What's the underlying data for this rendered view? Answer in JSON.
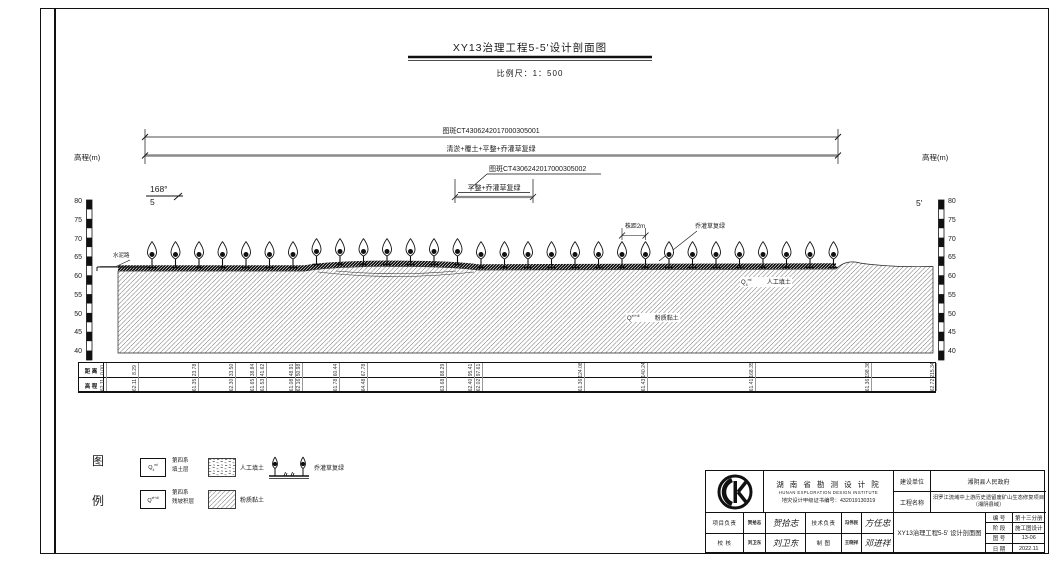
{
  "sheet": {
    "title": "XY13治理工程5-5'设计剖面图",
    "scale_label": "比例尺：1：500"
  },
  "annotations": {
    "patch1_label": "图斑CT4306242017000305001",
    "patch1_treatment": "清淤+覆土+平整+乔灌草复绿",
    "patch2_label": "图斑CT4306242017000305002",
    "patch2_treatment": "平整+乔灌草复绿",
    "section_start_angle": "168°",
    "section_start_id": "5",
    "section_end_id": "5'",
    "elevation_axis_label": "高程(m)",
    "cement_road_label": "水泥路",
    "plant_spacing_label": "株距2m",
    "regreen_label": "乔灌草复绿",
    "fill_soil_symbol": {
      "base": "Q",
      "sub": "4",
      "sup": "ml"
    },
    "fill_soil_label": "人工填土",
    "clay_symbol": {
      "base": "Q",
      "sub": "",
      "sup": "el+dl"
    },
    "clay_label": "粉质黏土"
  },
  "elevation_axis": {
    "ticks": [
      "80",
      "75",
      "70",
      "65",
      "60",
      "55",
      "50",
      "45",
      "40"
    ]
  },
  "profile_table": {
    "row_labels": [
      "距 离",
      "高 程"
    ],
    "total_length": 215.34,
    "columns": [
      {
        "d": "0.00",
        "e": "62.11"
      },
      {
        "d": "8.29",
        "e": "62.11"
      },
      {
        "d": "23.78",
        "e": "61.35"
      },
      {
        "d": "33.50",
        "e": "62.30"
      },
      {
        "d": "38.84",
        "e": "61.65"
      },
      {
        "d": "41.62",
        "e": "61.53"
      },
      {
        "d": "48.91",
        "e": "61.08"
      },
      {
        "d": "50.98",
        "e": "62.16"
      },
      {
        "d": "60.44",
        "e": "61.78"
      },
      {
        "d": "67.78",
        "e": "64.48"
      },
      {
        "d": "88.29",
        "e": "63.68"
      },
      {
        "d": "95.41",
        "e": "62.40"
      },
      {
        "d": "97.61",
        "e": "62.02"
      },
      {
        "d": "124.08",
        "e": "61.36"
      },
      {
        "d": "140.24",
        "e": "61.43"
      },
      {
        "d": "168.35",
        "e": "61.41"
      },
      {
        "d": "198.36",
        "e": "61.36"
      },
      {
        "d": "215.34",
        "e": "62.72"
      }
    ]
  },
  "legend": {
    "heading_chars": [
      "图",
      "例"
    ],
    "q4ml": {
      "symbol": {
        "base": "Q",
        "sub": "4",
        "sup": "ml"
      },
      "line1": "第四系",
      "line2": "填土层"
    },
    "qeldl": {
      "symbol": {
        "base": "Q",
        "sub": "",
        "sup": "el+dl"
      },
      "line1": "第四系",
      "line2": "残坡积层"
    },
    "fill_label": "人工填土",
    "clay_label": "粉质黏土",
    "regreen_label": "乔灌草复绿"
  },
  "title_block": {
    "institute_cn": "湖 南 省 勘 测 设 计 院",
    "institute_en": "HUNAN EXPLORATION DESIGN INSTITUTE",
    "certificate": "地灾设计甲级证书编号：432019130319",
    "client_label": "建设单位",
    "client": "湘阴县人民政府",
    "project_label": "工程名称",
    "project": "汨罗江流域中上游历史遗留废矿山生态修复项目（湘阴县域）",
    "drawing_title": "XY13治理工程5-5' 设计剖面图",
    "roles": {
      "project_lead_label": "项目负责",
      "project_lead_name": "贺拾志",
      "project_lead_sig": "贺拾志",
      "tech_lead_label": "技术负责",
      "tech_lead_name": "冯伟民",
      "tech_lead_sig": "方任忠",
      "checker_label": "校  核",
      "checker_name": "刘卫东",
      "checker_sig": "刘卫东",
      "drafter_label": "制  图",
      "drafter_name": "王晓祥",
      "drafter_sig": "邓进祥"
    },
    "meta": [
      {
        "label": "编 号",
        "value": "第十三分册"
      },
      {
        "label": "阶 段",
        "value": "施工图设计"
      },
      {
        "label": "图 号",
        "value": "13-06"
      },
      {
        "label": "日 期",
        "value": "2022.11"
      }
    ]
  },
  "drawing": {
    "tree_count": 30,
    "colors": {
      "ink": "#1a1a1a",
      "hatch_line": "#777",
      "dim_gray": "#8a8a8a"
    }
  }
}
